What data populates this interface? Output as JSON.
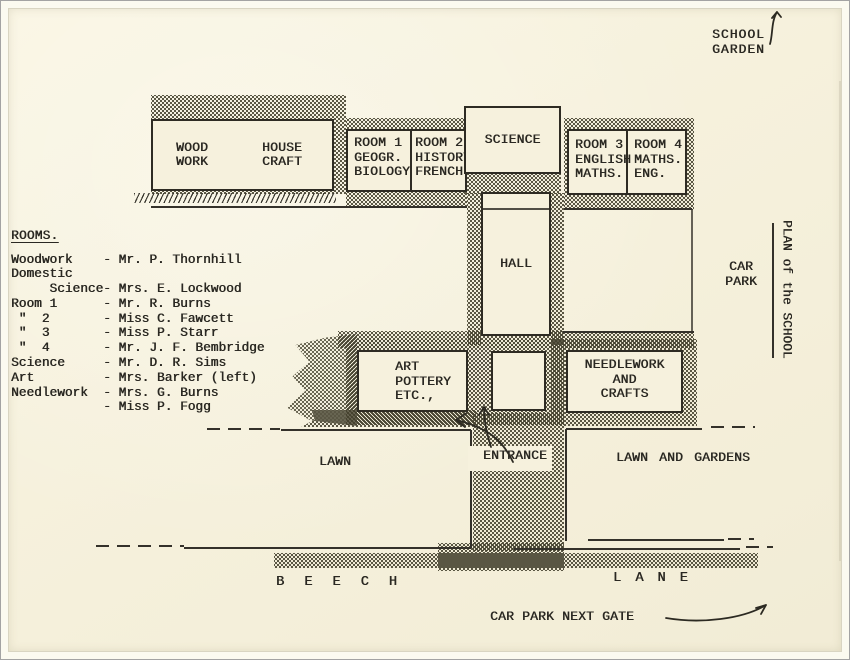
{
  "colors": {
    "paper": "#f6f1dd",
    "ink": "#2a2822",
    "frame": "#fbfaf0"
  },
  "corner_labels": {
    "school_garden_line1": "SCHOOL",
    "school_garden_line2": "GARDEN",
    "plan_title": "PLAN of the SCHOOL",
    "car_park_line1": "CAR",
    "car_park_line2": "PARK",
    "beech": "B E E C H",
    "lane": "L A N E",
    "car_park_next_gate": "CAR PARK NEXT GATE"
  },
  "rooms_list": {
    "heading": "ROOMS.",
    "lines": [
      "Woodwork    - Mr. P. Thornhill",
      "Domestic",
      "     Science- Mrs. E. Lockwood",
      "Room 1      - Mr. R. Burns",
      " \"  2       - Miss C. Fawcett",
      " \"  3       - Miss P. Starr",
      " \"  4       - Mr. J. F. Bembridge",
      "Science     - Mr. D. R. Sims",
      "Art         - Mrs. Barker (left)",
      "Needlework  - Mrs. G. Burns",
      "            - Miss P. Fogg"
    ]
  },
  "buildings": {
    "woodwork": {
      "line1": "WOOD",
      "line2": "WORK"
    },
    "housecraft": {
      "line1": "HOUSE",
      "line2": "CRAFT"
    },
    "room1": {
      "line1": "ROOM 1",
      "line2": "GEOGR.",
      "line3": "BIOLOGY"
    },
    "room2": {
      "line1": "ROOM 2",
      "line2": "HISTORY",
      "line3": "FRENCH"
    },
    "science": {
      "label": "SCIENCE"
    },
    "room3": {
      "line1": "ROOM 3",
      "line2": "ENGLISH",
      "line3": "MATHS."
    },
    "room4": {
      "line1": "ROOM 4",
      "line2": "MATHS.",
      "line3": "ENG."
    },
    "hall": {
      "label": "HALL"
    },
    "art": {
      "line1": "ART",
      "line2": "POTTERY",
      "line3": "ETC.,"
    },
    "needlework": {
      "line1": "NEEDLEWORK",
      "line2": "AND",
      "line3": "CRAFTS"
    }
  },
  "areas": {
    "lawn": "LAWN",
    "entrance": "ENTRANCE",
    "lawn_and_gardens": "LAWN AND GARDENS"
  }
}
